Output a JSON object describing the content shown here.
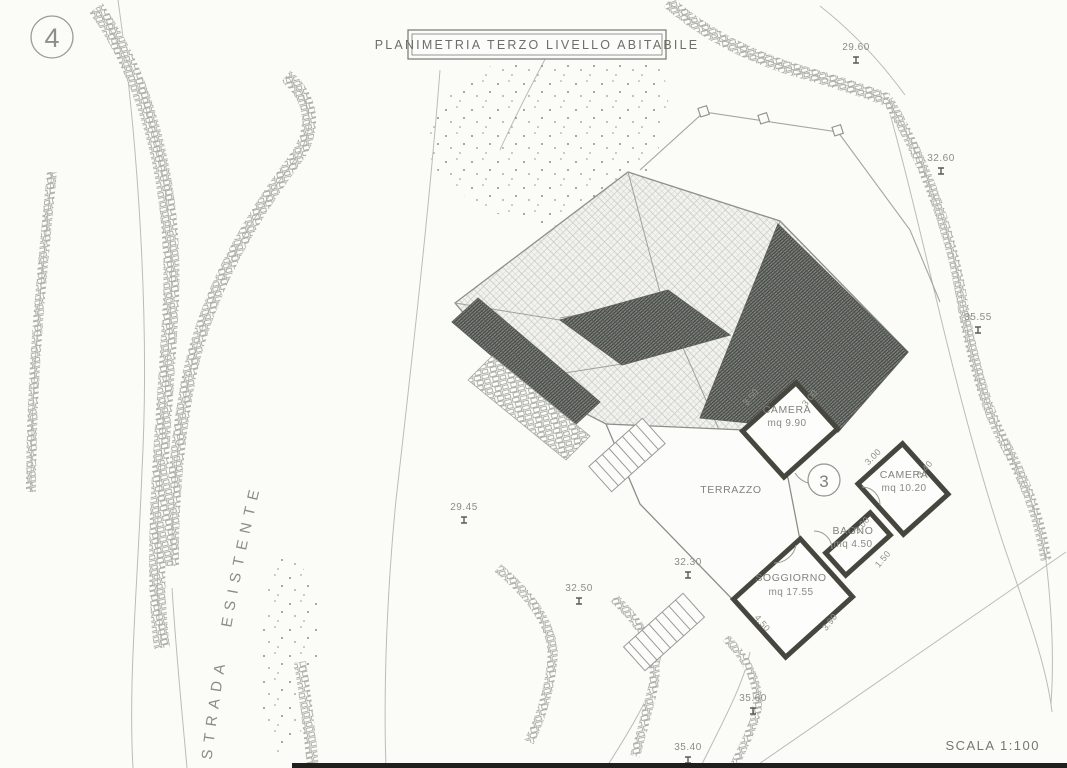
{
  "drawing": {
    "plate_number": "4",
    "detail_number": "3",
    "title": "PLANIMETRIA TERZO LIVELLO ABITABILE",
    "scale_label": "SCALA 1:100",
    "road_label": "STRADA ESISTENTE"
  },
  "rooms": [
    {
      "name": "CAMERA",
      "area": "mq 9.90"
    },
    {
      "name": "CAMERA",
      "area": "mq 10.20"
    },
    {
      "name": "TERRAZZO",
      "area": ""
    },
    {
      "name": "BAGNO",
      "area": "mq 4.50"
    },
    {
      "name": "SOGGIORNO",
      "area": "mq 17.55"
    }
  ],
  "elevations": [
    {
      "value": "29.60"
    },
    {
      "value": "32.60"
    },
    {
      "value": "35.55"
    },
    {
      "value": "29.45"
    },
    {
      "value": "32.30"
    },
    {
      "value": "32.50"
    },
    {
      "value": "35.60"
    },
    {
      "value": "35.40"
    }
  ],
  "dimensions": [
    {
      "value": "3.50"
    },
    {
      "value": "3.00"
    },
    {
      "value": "3.00"
    },
    {
      "value": "3.40"
    },
    {
      "value": "3.00"
    },
    {
      "value": "1.50"
    },
    {
      "value": "4.50"
    },
    {
      "value": "3.90"
    }
  ],
  "colors": {
    "line": "#9b9b96",
    "dark_roof": "#6f736d",
    "text": "#85857f",
    "paper": "#fbfbf8"
  }
}
